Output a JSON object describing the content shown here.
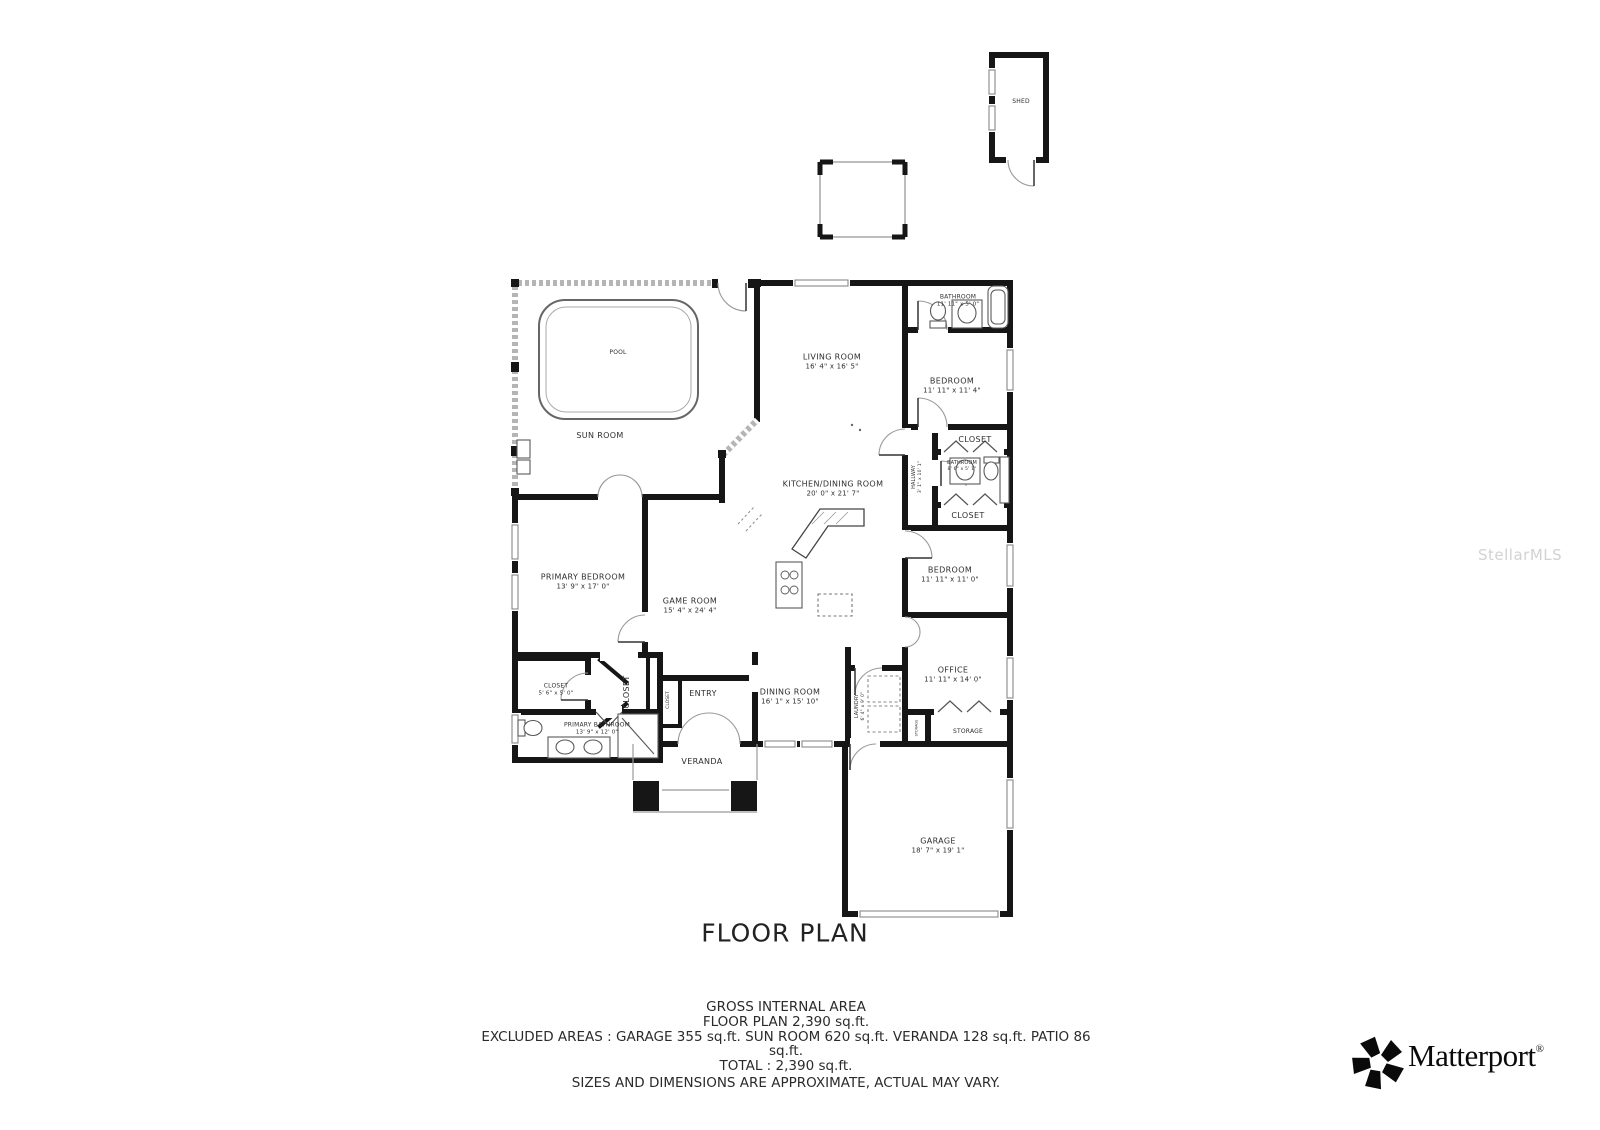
{
  "watermark": "StellarMLS",
  "title": "FLOOR PLAN",
  "shed": {
    "label": "SHED"
  },
  "rooms": {
    "pool": {
      "label": "POOL",
      "dims": ""
    },
    "sun_room": {
      "label": "SUN ROOM",
      "dims": ""
    },
    "living_room": {
      "label": "LIVING ROOM",
      "dims": "16' 4\" x 16' 5\""
    },
    "bathroom_1": {
      "label": "BATHROOM",
      "dims": "11' 11\" x 5' 0\""
    },
    "bedroom_1": {
      "label": "BEDROOM",
      "dims": "11' 11\" x 11' 4\""
    },
    "closet_1": {
      "label": "CLOSET",
      "dims": ""
    },
    "hallway": {
      "label": "HALLWAY",
      "dims": "3' 1\" x 10' 1\""
    },
    "bathroom_2": {
      "label": "BATHROOM",
      "dims": "8' 6\" x 5' 1\""
    },
    "closet_2": {
      "label": "CLOSET",
      "dims": ""
    },
    "kitchen_dining": {
      "label": "KITCHEN/DINING ROOM",
      "dims": "20' 0\" x 21' 7\""
    },
    "bedroom_2": {
      "label": "BEDROOM",
      "dims": "11' 11\" x 11' 0\""
    },
    "primary_bedroom": {
      "label": "PRIMARY BEDROOM",
      "dims": "13' 9\" x 17' 0\""
    },
    "game_room": {
      "label": "GAME ROOM",
      "dims": "15' 4\" x 24' 4\""
    },
    "office": {
      "label": "OFFICE",
      "dims": "11' 11\" x 14' 0\""
    },
    "dining_room": {
      "label": "DINING ROOM",
      "dims": "16' 1\" x 15' 10\""
    },
    "laundry": {
      "label": "LAUNDRY",
      "dims": "6' 4\" x 9' 0\""
    },
    "storage": {
      "label": "STORAGE",
      "dims": ""
    },
    "storage_small": {
      "label": "STORAGE",
      "dims": ""
    },
    "closet_3": {
      "label": "CLOSET",
      "dims": "5' 6\" x 5' 0\""
    },
    "primary_closet": {
      "label": "CLOSET",
      "dims": ""
    },
    "entry_closet": {
      "label": "CLOSET",
      "dims": ""
    },
    "primary_bathroom": {
      "label": "PRIMARY BATHROOM",
      "dims": "13' 9\" x 12' 0\""
    },
    "entry": {
      "label": "ENTRY",
      "dims": ""
    },
    "veranda": {
      "label": "VERANDA",
      "dims": ""
    },
    "garage": {
      "label": "GARAGE",
      "dims": "18' 7\" x 19' 1\""
    }
  },
  "footer": {
    "line1": "GROSS INTERNAL AREA",
    "line2": "FLOOR PLAN 2,390 sq.ft.",
    "line3": "EXCLUDED AREAS :  GARAGE 355 sq.ft.   SUN ROOM 620 sq.ft.   VERANDA 128 sq.ft.   PATIO 86",
    "line4": "sq.ft.",
    "line5": "TOTAL :  2,390 sq.ft.",
    "line6": "SIZES AND DIMENSIONS ARE APPROXIMATE, ACTUAL MAY VARY."
  },
  "brand": {
    "name": "Matterport",
    "registered": "®"
  }
}
